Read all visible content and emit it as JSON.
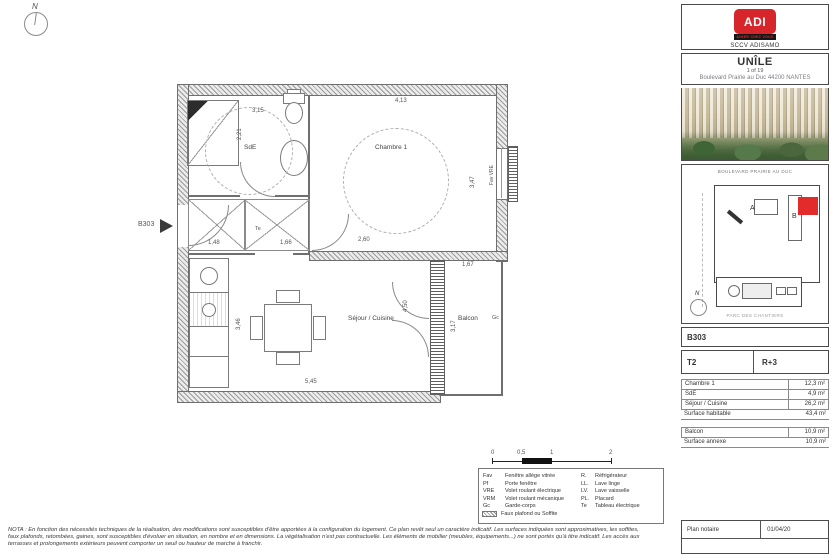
{
  "sidebar": {
    "logo": {
      "brand": "ADI",
      "tagline": "AIMER CHEZ VOUS",
      "company": "SCCV ADISAMO"
    },
    "project": {
      "name": "UNÎLE",
      "sheet": "1 of 19",
      "address": "Boulevard Prairie au Duc 44200 NANTES"
    },
    "siteplan": {
      "street_top": "BOULEVARD PRAIRIE AU DUC",
      "street_bottom": "PARC DES CHANTIERS",
      "block_a": "A",
      "block_b": "B",
      "north": "N"
    },
    "unit": {
      "ref": "B303",
      "type": "T2",
      "floor": "R+3"
    },
    "areas": {
      "rows": [
        {
          "label": "Chambre 1",
          "value": "12,3 m²"
        },
        {
          "label": "SdE",
          "value": "4,9 m²"
        },
        {
          "label": "Séjour / Cuisine",
          "value": "26,2 m²"
        }
      ],
      "total_label": "Surface habitable",
      "total_value": "43,4 m²",
      "annex_rows": [
        {
          "label": "Balcon",
          "value": "10,9 m²"
        }
      ],
      "annex_total_label": "Surface annexe",
      "annex_total_value": "10,9 m²"
    },
    "footer": {
      "label": "Plan notaire",
      "date": "01/04/20"
    }
  },
  "plan": {
    "unit_ref": "B303",
    "north": "N",
    "rooms": {
      "chambre": "Chambre 1",
      "sde": "SdE",
      "sejour": "Séjour / Cuisine",
      "balcon": "Balcon"
    },
    "dims": {
      "chambre_w": "4,13",
      "chambre_h": "3,47",
      "chambre_b": "2,60",
      "sde_w": "3,15",
      "sde_h": "2,21",
      "entry_w": "1,48",
      "hall_w": "1,66",
      "sejour_w": "5,45",
      "sejour_h": "3,46",
      "bay_h": "4,50",
      "balcon_w": "1,67",
      "balcon_h": "3,17"
    },
    "tags": {
      "gc": "Gc",
      "te": "Te",
      "window": "Fav VRE"
    }
  },
  "scalebar": {
    "ticks": [
      "0",
      "0,5",
      "1",
      "2"
    ]
  },
  "legend": {
    "left": [
      {
        "abbr": "Fav",
        "label": "Fenêtre allège vitrée"
      },
      {
        "abbr": "Pf",
        "label": "Porte fenêtre"
      },
      {
        "abbr": "VRE",
        "label": "Volet roulant électrique"
      },
      {
        "abbr": "VRM",
        "label": "Volet roulant mécanique"
      },
      {
        "abbr": "Gc",
        "label": "Garde-corps"
      },
      {
        "abbr": "",
        "label": "Faux plafond ou Soffite"
      }
    ],
    "right": [
      {
        "abbr": "R.",
        "label": "Réfrigérateur"
      },
      {
        "abbr": "LL.",
        "label": "Lave linge"
      },
      {
        "abbr": "LV.",
        "label": "Lave vaisselle"
      },
      {
        "abbr": "PL.",
        "label": "Placard"
      },
      {
        "abbr": "Te",
        "label": "Tableau électrique"
      }
    ]
  },
  "nota": "NOTA : En fonction des nécessités techniques de la réalisation, des modifications sont susceptibles d'être apportées à la configuration du logement. Ce plan revêt seul un caractère indicatif. Les surfaces indiquées sont approximatives, les soffites, faux plafonds, retombées, gaines, sont susceptibles d'évoluer en situation, en nombre et en dimensions. La végétalisation n'est pas contractuelle. Les éléments de mobilier (meubles, équipements...) ne sont portés qu'à titre indicatif. Les accès aux terrasses et prolongements extérieurs peuvent comporter un seuil ou hauteur de marche à franchir."
}
